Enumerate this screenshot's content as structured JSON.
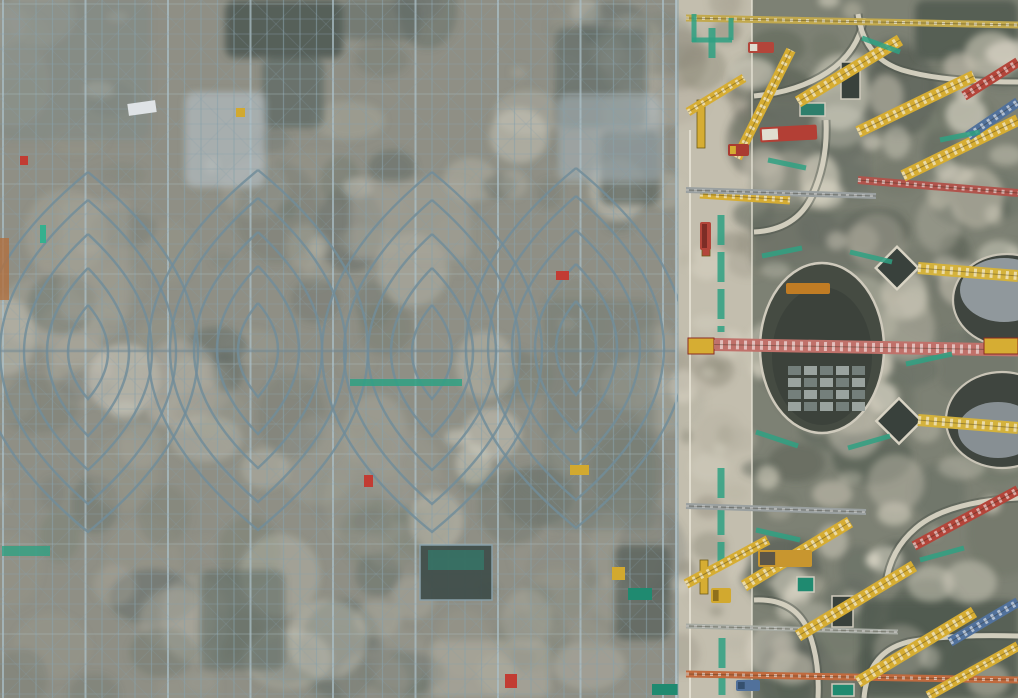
{
  "meta": {
    "title": "Aerial view of construction site",
    "description": "Top-down drone photo: left two-thirds is dense steel scaffolding with concentric lens-shaped roof ribs; a light concrete access road with green painted stripes runs vertically; right third is a foundation slab with circular pits, rotated skylight frames, and many yellow, red and blue lattice crane booms."
  },
  "canvas": {
    "w": 1018,
    "h": 698
  },
  "palette": {
    "steel": "#87a0ab",
    "steel_light": "#aec2ca",
    "steel_dark": "#65808c",
    "ground": "#8f8d80",
    "road": "#c3beae",
    "slab": "#7d8174",
    "yellow": "#d6ad33",
    "red": "#b3453a",
    "pink_red": "#c0716a",
    "orange": "#c06a3e",
    "blue": "#51719b",
    "teal": "#2fa183",
    "white": "#e9e5d8"
  },
  "scaffold_zone": {
    "bounds": [
      0,
      0,
      678,
      698
    ],
    "ground": "#8f8d80",
    "blotches": {
      "seed": 7,
      "count": 185,
      "rmin": 7,
      "rmax": 44,
      "omin": 0.16,
      "omax": 0.5,
      "colors": [
        "#c9c4b4",
        "#dcd7c7",
        "#6e7568",
        "#55605a",
        "#9a9789",
        "#b3ae9f"
      ]
    },
    "patches": [
      {
        "x": 225,
        "y": 0,
        "w": 118,
        "h": 58,
        "c": "#454f48",
        "o": 0.85
      },
      {
        "x": 262,
        "y": 58,
        "w": 62,
        "h": 70,
        "c": "#55605a",
        "o": 0.7
      },
      {
        "x": 555,
        "y": 28,
        "w": 92,
        "h": 100,
        "c": "#55605a",
        "o": 0.6
      },
      {
        "x": 600,
        "y": 130,
        "w": 60,
        "h": 75,
        "c": "#454f48",
        "o": 0.6
      },
      {
        "x": 185,
        "y": 92,
        "w": 80,
        "h": 95,
        "c": "#b9c2c6",
        "o": 0.65
      },
      {
        "x": 558,
        "y": 95,
        "w": 104,
        "h": 86,
        "c": "#aebac0",
        "o": 0.55
      },
      {
        "x": 340,
        "y": 0,
        "w": 80,
        "h": 40,
        "c": "#55605a",
        "o": 0.5
      },
      {
        "x": 0,
        "y": 0,
        "w": 150,
        "h": 140,
        "c": "#7a8580",
        "o": 0.45
      },
      {
        "x": 200,
        "y": 570,
        "w": 85,
        "h": 100,
        "c": "#55605a",
        "o": 0.55
      },
      {
        "x": 545,
        "y": 300,
        "w": 110,
        "h": 230,
        "c": "#70786e",
        "o": 0.5
      },
      {
        "x": 615,
        "y": 545,
        "w": 55,
        "h": 95,
        "c": "#454f48",
        "o": 0.6
      },
      {
        "x": 430,
        "y": 640,
        "w": 120,
        "h": 58,
        "c": "#b9b4a4",
        "o": 0.5
      },
      {
        "x": 60,
        "y": 200,
        "w": 70,
        "h": 120,
        "c": "#a5a193",
        "o": 0.5
      },
      {
        "x": 350,
        "y": 180,
        "w": 120,
        "h": 80,
        "c": "#a9a597",
        "o": 0.5
      }
    ],
    "grid": {
      "v_spacing": 16.5,
      "h_spacing": 15,
      "diag_spacing": 50,
      "v_opacity": 0.58,
      "h_opacity": 0.4,
      "d_opacity": 0.22,
      "heavy_every": 5
    },
    "lenses": {
      "centers": [
        {
          "cx": 88,
          "cy": 352
        },
        {
          "cx": 258,
          "cy": 350
        },
        {
          "cx": 432,
          "cy": 352
        },
        {
          "cx": 576,
          "cy": 348
        }
      ],
      "scales": [
        [
          110,
          180
        ],
        [
          88,
          152
        ],
        [
          64,
          118
        ],
        [
          41,
          84
        ],
        [
          20,
          47
        ]
      ],
      "color": "#6d8997",
      "width": 2.4,
      "opacity": 0.85
    },
    "chord_y": 351,
    "wash": {
      "color": "#8fa7b2",
      "opacity": 0.1
    },
    "edge_x": 676,
    "skylight_box": {
      "x": 420,
      "y": 545,
      "w": 72,
      "h": 55,
      "c": "#33413c",
      "glass": {
        "x": 428,
        "y": 550,
        "w": 56,
        "h": 20,
        "c": "#2e6e5e"
      }
    },
    "specks": [
      {
        "x": 128,
        "y": 102,
        "w": 28,
        "h": 12,
        "c": "#dfe3e6",
        "rot": -8
      },
      {
        "x": 556,
        "y": 271,
        "w": 13,
        "h": 9,
        "c": "#c23c33"
      },
      {
        "x": 364,
        "y": 475,
        "w": 9,
        "h": 12,
        "c": "#c23c33"
      },
      {
        "x": 505,
        "y": 674,
        "w": 12,
        "h": 14,
        "c": "#c23c33"
      },
      {
        "x": 20,
        "y": 156,
        "w": 8,
        "h": 9,
        "c": "#c23c33"
      },
      {
        "x": 612,
        "y": 567,
        "w": 13,
        "h": 13,
        "c": "#d2a92f"
      },
      {
        "x": 570,
        "y": 465,
        "w": 19,
        "h": 10,
        "c": "#d2a92f"
      },
      {
        "x": 236,
        "y": 108,
        "w": 9,
        "h": 9,
        "c": "#d2a92f"
      },
      {
        "x": 0,
        "y": 238,
        "w": 9,
        "h": 62,
        "c": "#b07040",
        "o": 0.8
      },
      {
        "x": 40,
        "y": 225,
        "w": 6,
        "h": 18,
        "c": "#35b08e"
      },
      {
        "x": 350,
        "y": 379,
        "w": 112,
        "h": 7,
        "c": "#2fa183",
        "o": 0.85
      },
      {
        "x": 2,
        "y": 546,
        "w": 48,
        "h": 10,
        "c": "#2fa183",
        "o": 0.8
      },
      {
        "x": 628,
        "y": 588,
        "w": 24,
        "h": 12,
        "c": "#1f8a70"
      },
      {
        "x": 652,
        "y": 684,
        "w": 30,
        "h": 11,
        "c": "#1f8a70"
      }
    ]
  },
  "road": {
    "bounds": [
      676,
      0,
      78,
      698
    ],
    "base": "#c3beae",
    "blotches": {
      "seed": 11,
      "count": 46,
      "rmin": 6,
      "rmax": 26,
      "omin": 0.25,
      "omax": 0.55,
      "colors": [
        "#dcd7c7",
        "#8f8c7c",
        "#b5b0a0"
      ]
    },
    "white_line_x": 690,
    "fence_x": 678,
    "green_stripes": [
      {
        "x": 721,
        "y1": 215,
        "y2": 332
      },
      {
        "x": 721,
        "y1": 468,
        "y2": 562
      },
      {
        "x": 722,
        "y1": 638,
        "y2": 695
      },
      {
        "x": 712,
        "y1": 28,
        "y2": 58
      }
    ],
    "masts": [
      {
        "x": 697,
        "y": 100,
        "w": 8,
        "h": 48,
        "c": "#d6ad33"
      },
      {
        "x": 702,
        "y": 226,
        "w": 8,
        "h": 30,
        "c": "#b3453a"
      },
      {
        "x": 700,
        "y": 560,
        "w": 8,
        "h": 34,
        "c": "#d6ad33"
      }
    ]
  },
  "slab_zone": {
    "bounds": [
      752,
      0,
      266,
      698
    ],
    "base": "#7d8174",
    "edge_x": 752,
    "dark_blotches": {
      "seed": 23,
      "count": 72,
      "rmin": 8,
      "rmax": 40,
      "omin": 0.25,
      "omax": 0.6,
      "colors": [
        "#4d554c",
        "#5d655b",
        "#6e7366"
      ]
    },
    "light_blotches": {
      "seed": 31,
      "count": 84,
      "rmin": 5,
      "rmax": 30,
      "omin": 0.3,
      "omax": 0.7,
      "colors": [
        "#d5d0c0",
        "#e0dbcb",
        "#c2bdad"
      ]
    },
    "patches": [
      {
        "x": 915,
        "y": 0,
        "w": 103,
        "h": 60,
        "c": "#4d554c",
        "o": 0.8
      },
      {
        "x": 752,
        "y": 210,
        "w": 150,
        "h": 60,
        "c": "#6b7066",
        "o": 0.6
      },
      {
        "x": 860,
        "y": 600,
        "w": 158,
        "h": 98,
        "c": "#4d554c",
        "o": 0.75
      },
      {
        "x": 752,
        "y": 95,
        "w": 120,
        "h": 110,
        "c": "#6e7369",
        "o": 0.5
      },
      {
        "x": 940,
        "y": 330,
        "w": 78,
        "h": 60,
        "c": "#6b7066",
        "o": 0.5
      }
    ],
    "curves": [
      "M 754,96 Q 798,92 828,72 Q 858,52 864,18",
      "M 858,14 Q 864,58 902,70 Q 942,82 1018,82",
      "M 754,232 Q 796,230 812,196 Q 828,162 826,120",
      "M 754,600 Q 794,598 808,630 Q 820,660 818,698",
      "M 864,698 Q 868,652 908,642 Q 950,634 1018,636",
      "M 1018,498 Q 946,502 916,528 Q 890,550 886,584"
    ],
    "big_pit": {
      "cx": 822,
      "cy": 348,
      "rx": 62,
      "ry": 85,
      "fill": "#454b42",
      "rim": "#cfcabc",
      "pallets": {
        "x0": 788,
        "y0": 366,
        "cols": 5,
        "rows": 4,
        "w": 13,
        "h": 9,
        "gx": 3,
        "gy": 3,
        "c": "#9aa39f",
        "c2": "#747f7b"
      },
      "digger": {
        "x": 786,
        "y": 283,
        "w": 44,
        "h": 11,
        "c": "#c07c24"
      }
    },
    "edge_pits": [
      {
        "cx": 1007,
        "cy": 300,
        "rx": 54,
        "ry": 46,
        "cover": {
          "cx": 1004,
          "cy": 290,
          "rx": 44,
          "ry": 32,
          "c": "#97a0a4"
        }
      },
      {
        "cx": 1002,
        "cy": 420,
        "rx": 56,
        "ry": 48,
        "cover": {
          "cx": 998,
          "cy": 430,
          "rx": 40,
          "ry": 28,
          "c": "#8d969a"
        }
      }
    ],
    "diamonds": [
      {
        "cx": 897,
        "cy": 268,
        "s": 30
      },
      {
        "cx": 899,
        "cy": 421,
        "s": 32
      }
    ],
    "vents": [
      {
        "x": 841,
        "y": 62,
        "w": 19,
        "h": 37
      },
      {
        "x": 832,
        "y": 596,
        "w": 21,
        "h": 31
      },
      {
        "x": 800,
        "y": 103,
        "w": 25,
        "h": 13,
        "c": "#2e7f6c"
      },
      {
        "x": 797,
        "y": 577,
        "w": 17,
        "h": 15,
        "c": "#1f8a70"
      },
      {
        "x": 832,
        "y": 684,
        "w": 22,
        "h": 12,
        "c": "#1f8a70"
      }
    ]
  },
  "machinery": {
    "trusses": [
      {
        "x1": 686,
        "y1": 18,
        "x2": 1018,
        "y2": 25,
        "w": 7,
        "c": "#c2a94e"
      },
      {
        "x1": 700,
        "y1": 194,
        "x2": 790,
        "y2": 200,
        "w": 9,
        "c": "#d6ad33"
      },
      {
        "x1": 686,
        "y1": 190,
        "x2": 876,
        "y2": 196,
        "w": 6,
        "c": "#9aa0a0"
      },
      {
        "x1": 858,
        "y1": 180,
        "x2": 1018,
        "y2": 193,
        "w": 8,
        "c": "#b0544c"
      },
      {
        "x1": 688,
        "y1": 344,
        "x2": 1018,
        "y2": 350,
        "w": 13,
        "c": "#c0716a"
      },
      {
        "x1": 918,
        "y1": 268,
        "x2": 1018,
        "y2": 276,
        "w": 12,
        "c": "#d4b23c"
      },
      {
        "x1": 918,
        "y1": 420,
        "x2": 1018,
        "y2": 428,
        "w": 12,
        "c": "#d4b23c"
      },
      {
        "x1": 686,
        "y1": 506,
        "x2": 866,
        "y2": 512,
        "w": 6,
        "c": "#9aa0a0"
      },
      {
        "x1": 686,
        "y1": 674,
        "x2": 1018,
        "y2": 680,
        "w": 7,
        "c": "#c06a3e"
      },
      {
        "x1": 686,
        "y1": 626,
        "x2": 898,
        "y2": 632,
        "w": 5,
        "c": "#a8aca4"
      },
      {
        "x1": 737,
        "y1": 158,
        "x2": 791,
        "y2": 50,
        "w": 10,
        "c": "#d6ad33"
      },
      {
        "x1": 798,
        "y1": 102,
        "x2": 900,
        "y2": 40,
        "w": 12,
        "c": "#d6ad33"
      },
      {
        "x1": 858,
        "y1": 132,
        "x2": 974,
        "y2": 76,
        "w": 12,
        "c": "#d6ad33"
      },
      {
        "x1": 903,
        "y1": 176,
        "x2": 1018,
        "y2": 120,
        "w": 12,
        "c": "#d6ad33"
      },
      {
        "x1": 964,
        "y1": 96,
        "x2": 1018,
        "y2": 62,
        "w": 10,
        "c": "#b3453a"
      },
      {
        "x1": 968,
        "y1": 136,
        "x2": 1018,
        "y2": 102,
        "w": 10,
        "c": "#51719b"
      },
      {
        "x1": 688,
        "y1": 112,
        "x2": 744,
        "y2": 78,
        "w": 9,
        "c": "#d6ad33"
      },
      {
        "x1": 744,
        "y1": 586,
        "x2": 850,
        "y2": 522,
        "w": 12,
        "c": "#d6ad33"
      },
      {
        "x1": 798,
        "y1": 636,
        "x2": 914,
        "y2": 566,
        "w": 12,
        "c": "#d6ad33"
      },
      {
        "x1": 858,
        "y1": 682,
        "x2": 974,
        "y2": 612,
        "w": 12,
        "c": "#d6ad33"
      },
      {
        "x1": 928,
        "y1": 696,
        "x2": 1018,
        "y2": 646,
        "w": 10,
        "c": "#d6ad33"
      },
      {
        "x1": 914,
        "y1": 546,
        "x2": 1018,
        "y2": 490,
        "w": 10,
        "c": "#b3453a"
      },
      {
        "x1": 950,
        "y1": 642,
        "x2": 1018,
        "y2": 602,
        "w": 10,
        "c": "#51719b"
      },
      {
        "x1": 686,
        "y1": 584,
        "x2": 768,
        "y2": 540,
        "w": 10,
        "c": "#d6ad33"
      }
    ],
    "truss_blocks": [
      {
        "x": 688,
        "y": 338,
        "w": 26,
        "h": 16,
        "c": "#d6ad33"
      },
      {
        "x": 984,
        "y": 338,
        "w": 34,
        "h": 16,
        "c": "#d6ad33"
      }
    ],
    "vehicles": [
      {
        "x": 760,
        "y": 126,
        "w": 57,
        "h": 15,
        "rot": -3,
        "c": "#b33f35",
        "c2": "#e0ddd0"
      },
      {
        "x": 700,
        "y": 222,
        "w": 11,
        "h": 28,
        "rot": 0,
        "c": "#b3453a",
        "c2": "#7d2d26"
      },
      {
        "x": 748,
        "y": 42,
        "w": 26,
        "h": 11,
        "rot": 0,
        "c": "#b3453a",
        "c2": "#e0ddd0"
      },
      {
        "x": 758,
        "y": 550,
        "w": 54,
        "h": 17,
        "rot": 0,
        "c": "#c8962f",
        "c2": "#5c5648"
      },
      {
        "x": 728,
        "y": 144,
        "w": 21,
        "h": 12,
        "rot": 0,
        "c": "#aa3b31",
        "c2": "#d6ad33"
      },
      {
        "x": 711,
        "y": 588,
        "w": 20,
        "h": 15,
        "rot": 0,
        "c": "#d2a92f",
        "c2": "#8f701c"
      },
      {
        "x": 736,
        "y": 680,
        "w": 24,
        "h": 11,
        "rot": 0,
        "c": "#51719b",
        "c2": "#35506e"
      }
    ],
    "green_segments": [
      [
        694,
        14,
        694,
        42
      ],
      [
        692,
        40,
        732,
        40
      ],
      [
        731,
        40,
        731,
        18
      ],
      [
        762,
        256,
        802,
        248
      ],
      [
        850,
        252,
        892,
        262
      ],
      [
        756,
        432,
        798,
        446
      ],
      [
        848,
        448,
        890,
        436
      ],
      [
        906,
        364,
        952,
        354
      ],
      [
        862,
        38,
        900,
        52
      ],
      [
        768,
        160,
        806,
        168
      ],
      [
        940,
        140,
        980,
        132
      ],
      [
        756,
        530,
        800,
        540
      ],
      [
        920,
        560,
        964,
        548
      ]
    ]
  }
}
